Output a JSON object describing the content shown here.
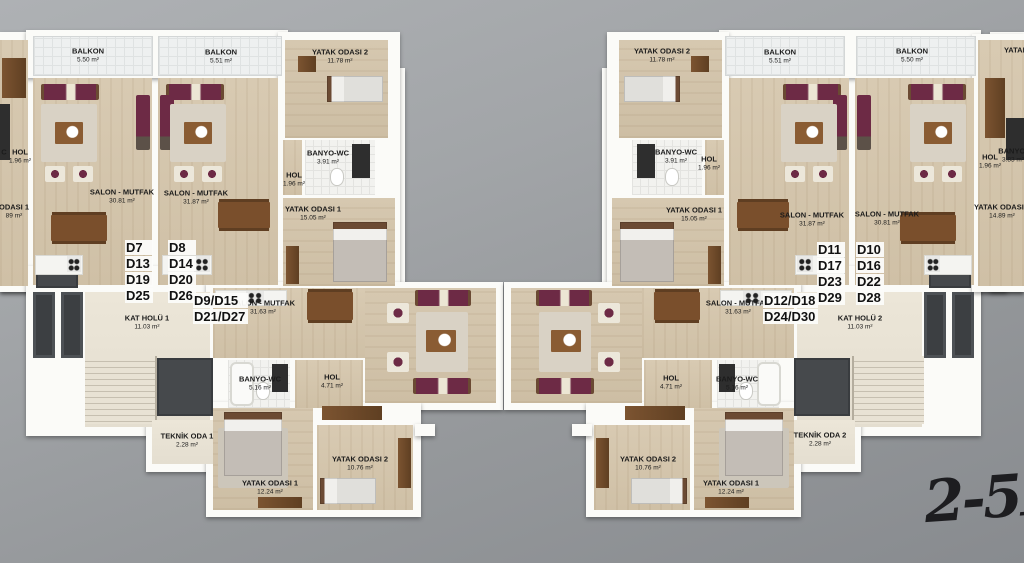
{
  "plan_title": "Apartment typical floor plan (floors 2-5)",
  "floor_note": {
    "text": "2-5F",
    "partial_char": "C"
  },
  "colors": {
    "background_top": "#aeb1b4",
    "background_bottom": "#888b8f",
    "wall": "#fbfbf8",
    "wood_floor": "#d3c4ab",
    "common_floor": "#e9e3d5",
    "balcony_floor": "#eef0f0",
    "shaft_dark": "#3c3f42",
    "sofa_accent": "#6d2a45",
    "furniture_wood": "#7a4f2c",
    "label_text": "#1b1b1b"
  },
  "room_labels": [
    {
      "n": "BALKON",
      "a": "5.50 m²",
      "x": 88,
      "y": 55
    },
    {
      "n": "BALKON",
      "a": "5.51 m²",
      "x": 221,
      "y": 56
    },
    {
      "n": "YATAK ODASI 2",
      "a": "11.78 m²",
      "x": 340,
      "y": 56
    },
    {
      "n": "C",
      "a": "",
      "x": 4,
      "y": 152
    },
    {
      "n": "HOL",
      "a": "1.96 m²",
      "x": 20,
      "y": 156
    },
    {
      "n": "ODASI 1",
      "a": "89 m²",
      "x": 14,
      "y": 211
    },
    {
      "n": "SALON - MUTFAK",
      "a": "30.81 m²",
      "x": 122,
      "y": 196
    },
    {
      "n": "SALON - MUTFAK",
      "a": "31.87 m²",
      "x": 196,
      "y": 197
    },
    {
      "n": "BANYO-WC",
      "a": "3.91 m²",
      "x": 328,
      "y": 157
    },
    {
      "n": "HOL",
      "a": "1.96 m²",
      "x": 294,
      "y": 179
    },
    {
      "n": "YATAK ODASI 1",
      "a": "15.05 m²",
      "x": 313,
      "y": 213
    },
    {
      "n": "KAT HOLÜ 1",
      "a": "11.03 m²",
      "x": 147,
      "y": 322
    },
    {
      "n": "SALON - MUTFAK",
      "a": "31.63 m²",
      "x": 263,
      "y": 307
    },
    {
      "n": "BANYO-WC",
      "a": "5.16 m²",
      "x": 260,
      "y": 383
    },
    {
      "n": "HOL",
      "a": "4.71 m²",
      "x": 332,
      "y": 381
    },
    {
      "n": "TEKNİK ODA 1",
      "a": "2.28 m²",
      "x": 187,
      "y": 440
    },
    {
      "n": "YATAK ODASI 1",
      "a": "12.24 m²",
      "x": 270,
      "y": 487
    },
    {
      "n": "YATAK ODASI 2",
      "a": "10.76 m²",
      "x": 360,
      "y": 463
    },
    {
      "n": "YATAK ODASI 2",
      "a": "11.78 m²",
      "x": 662,
      "y": 55
    },
    {
      "n": "BALKON",
      "a": "5.51 m²",
      "x": 780,
      "y": 56
    },
    {
      "n": "BALKON",
      "a": "5.50 m²",
      "x": 912,
      "y": 55
    },
    {
      "n": "BANYO-WC",
      "a": "3.91 m²",
      "x": 676,
      "y": 156
    },
    {
      "n": "HOL",
      "a": "1.96 m²",
      "x": 709,
      "y": 163
    },
    {
      "n": "YATAK ODASI 1",
      "a": "15.05 m²",
      "x": 694,
      "y": 214
    },
    {
      "n": "SALON - MUTFAK",
      "a": "31.87 m²",
      "x": 812,
      "y": 219
    },
    {
      "n": "SALON - MUTFAK",
      "a": "30.81 m²",
      "x": 887,
      "y": 218
    },
    {
      "n": "HOL",
      "a": "1.96 m²",
      "x": 990,
      "y": 161
    },
    {
      "n": "BANYO-",
      "a": "3.83 m²",
      "x": 1013,
      "y": 155
    },
    {
      "n": "YATAK",
      "a": "",
      "x": 1016,
      "y": 50
    },
    {
      "n": "YATAK ODASI 1",
      "a": "14.89 m²",
      "x": 1002,
      "y": 211
    },
    {
      "n": "KAT HOLÜ 2",
      "a": "11.03 m²",
      "x": 860,
      "y": 322
    },
    {
      "n": "SALON - MUTFAK",
      "a": "31.63 m²",
      "x": 738,
      "y": 307
    },
    {
      "n": "HOL",
      "a": "4.71 m²",
      "x": 671,
      "y": 382
    },
    {
      "n": "BANYO-WC",
      "a": "5.16 m²",
      "x": 737,
      "y": 383
    },
    {
      "n": "TEKNİK ODA 2",
      "a": "2.28 m²",
      "x": 820,
      "y": 439
    },
    {
      "n": "YATAK ODASI 2",
      "a": "10.76 m²",
      "x": 648,
      "y": 463
    },
    {
      "n": "YATAK ODASI 1",
      "a": "12.24 m²",
      "x": 731,
      "y": 487
    }
  ],
  "unit_labels": [
    {
      "lines": [
        "D7",
        "D13",
        "D19",
        "D25"
      ],
      "x": 125,
      "y": 240
    },
    {
      "lines": [
        "D8",
        "D14",
        "D20",
        "D26"
      ],
      "x": 168,
      "y": 240
    },
    {
      "lines": [
        "D9/D15",
        "D21/D27"
      ],
      "x": 193,
      "y": 293
    },
    {
      "lines": [
        "D11",
        "D17",
        "D23",
        "D29"
      ],
      "x": 817,
      "y": 242
    },
    {
      "lines": [
        "D10",
        "D16",
        "D22",
        "D28"
      ],
      "x": 856,
      "y": 242
    },
    {
      "lines": [
        "D12/D18",
        "D24/D30"
      ],
      "x": 763,
      "y": 293
    }
  ]
}
